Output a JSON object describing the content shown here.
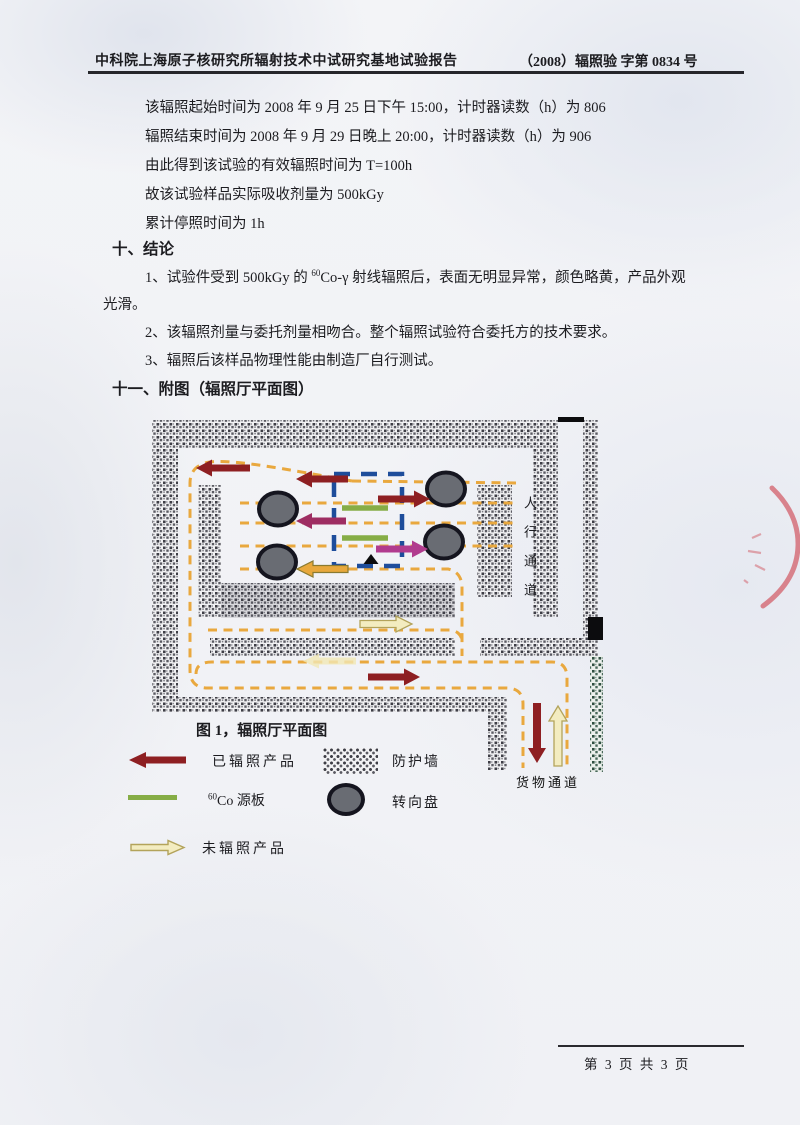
{
  "header": {
    "left": "中科院上海原子核研究所辐射技术中试研究基地试验报告",
    "right": "（2008）辐照验  字第  0834 号"
  },
  "body": {
    "lines": [
      "该辐照起始时间为 2008 年 9 月 25 日下午 15:00，计时器读数（h）为 806",
      "辐照结束时间为 2008 年 9 月 29 日晚上 20:00，计时器读数（h）为 906",
      "由此得到该试验的有效辐照时间为 T=100h",
      "故该试验样品实际吸收剂量为 500kGy",
      "累计停照时间为 1h"
    ],
    "section10_title": "十、结论",
    "item1_pre": "1、试验件受到 500kGy 的 ",
    "item1_sup": "60",
    "item1_post": "Co-γ 射线辐照后，表面无明显异常，颜色略黄，产品外观",
    "item1_cont": "光滑。",
    "item2": "2、该辐照剂量与委托剂量相吻合。整个辐照试验符合委托方的技术要求。",
    "item3": "3、辐照后该样品物理性能由制造厂自行测试。",
    "section11_title": "十一、附图（辐照厅平面图）"
  },
  "figure": {
    "caption": "图 1，辐照厅平面图",
    "label_pedestrian": "人行通道",
    "label_cargo": "货物通道",
    "legend": {
      "irradiated": "已辐照产品",
      "shield_wall": "防护墙",
      "co60_sup": "60",
      "co60_label": "Co 源板",
      "turntable": "转向盘",
      "unirradiated": "未辐照产品"
    }
  },
  "footer": {
    "page_text": "第  3 页 共  3 页"
  },
  "colors": {
    "arrow_irradiated": "#8e1f22",
    "arrow_unirradiated_fill": "#f3ecc0",
    "arrow_unirradiated_stroke": "#b3a35a",
    "arrow_magenta": "#b13b8e",
    "arrow_purple": "#9e2d62",
    "arrow_orange": "#e8a83c",
    "source_plate_green": "#86ad46",
    "path_dash_orange": "#e9a83e",
    "frame_dash_blue": "#1e4d9b",
    "turntable_fill": "#696c73",
    "stamp_red": "#cf4a55"
  }
}
